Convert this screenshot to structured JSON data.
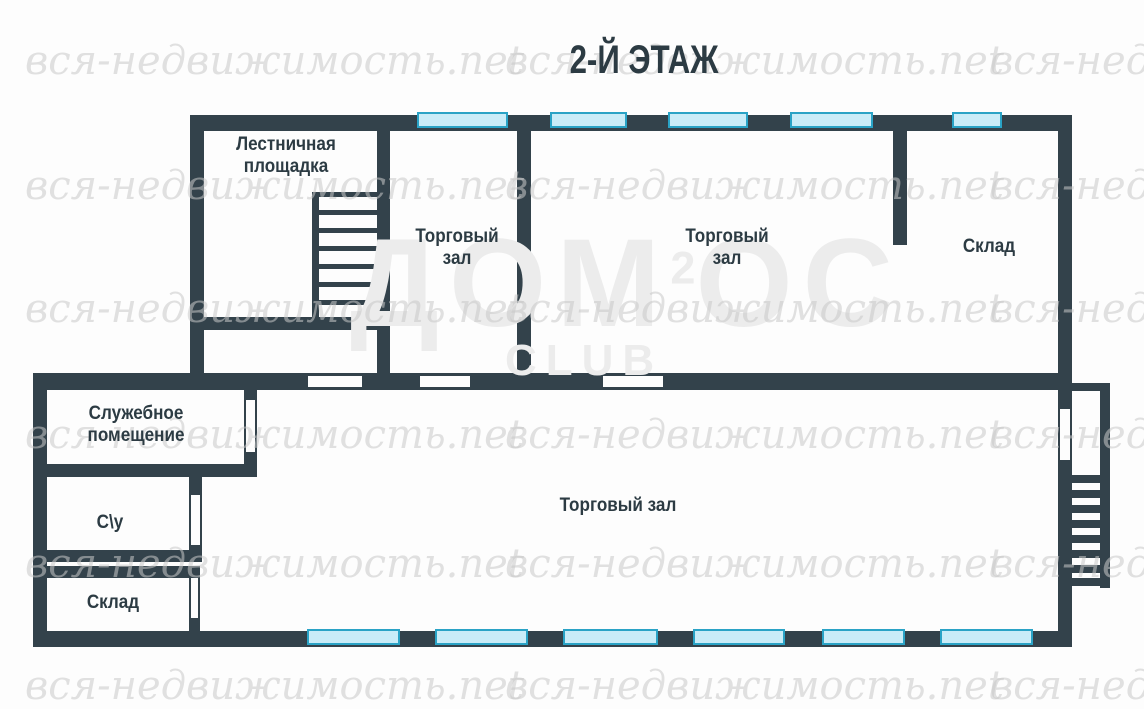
{
  "title": "2-Й ЭТАЖ",
  "rooms": {
    "stair_landing": {
      "label": "Лестничная площадка"
    },
    "sales_hall_top_small": {
      "label": "Торговый зал"
    },
    "sales_hall_top_large": {
      "label": "Торговый зал"
    },
    "storage_top": {
      "label": "Склад"
    },
    "service_room": {
      "label": "Служебное помещение"
    },
    "wc": {
      "label": "С\\у"
    },
    "storage_bottom": {
      "label": "Склад"
    },
    "sales_hall_main": {
      "label": "Торговый зал"
    }
  },
  "watermark": {
    "site": "вся-недвижимость.net",
    "logo_prefix": "ДОМ",
    "logo_sup": "2",
    "logo_suffix": "ОС",
    "logo_sub": "CLUB"
  },
  "colors": {
    "wall": "#33424b",
    "window_fill": "#c9ecf8",
    "window_border": "#2aa3c6",
    "label": "#2c3b43",
    "background": "#fdfdfd",
    "watermark": "#c9c9c9",
    "logo": "#ececec"
  }
}
